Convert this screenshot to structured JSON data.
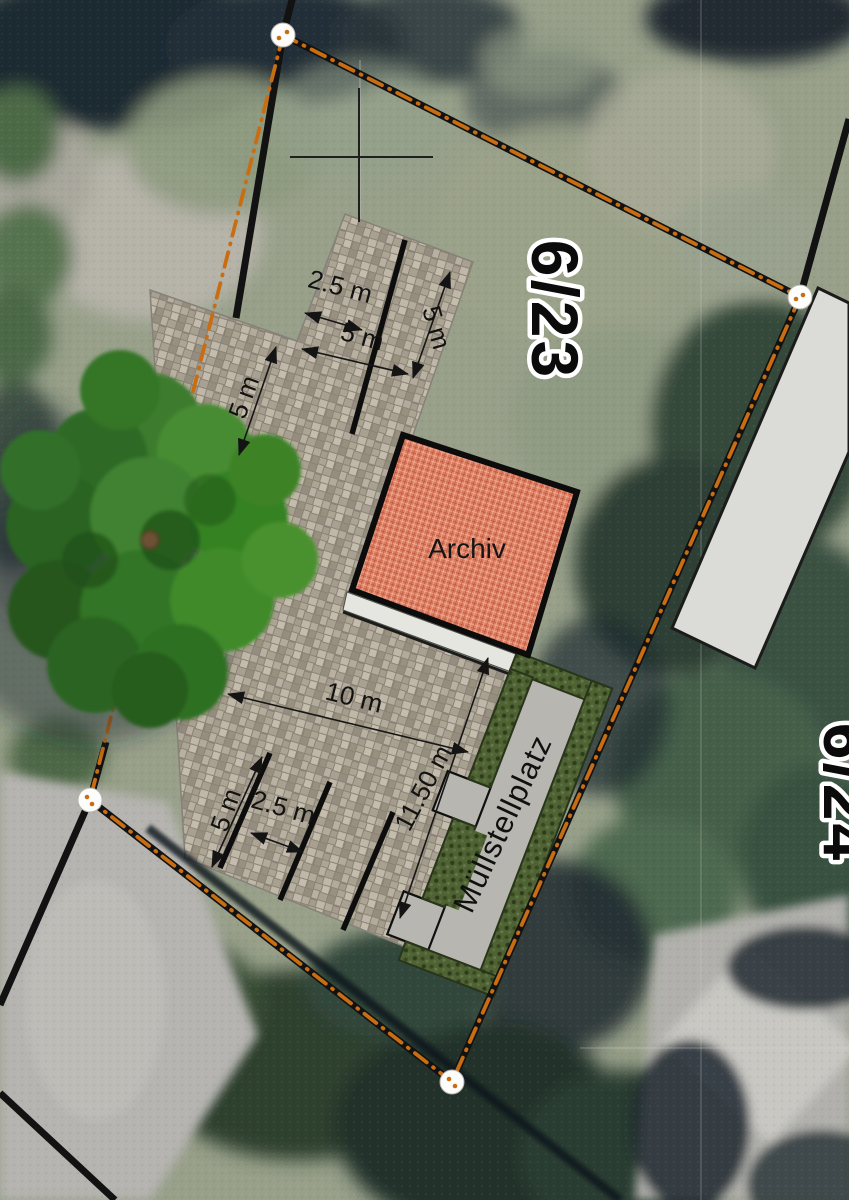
{
  "plan": {
    "parcel_label": "6/23",
    "adjacent_parcel_label": "6/24",
    "building_label": "Archiv",
    "waste_area_label": "Müllstellplatz",
    "dimensions": {
      "upper_offset": "2.5 m",
      "upper_right_depth": "5 m",
      "upper_center_width": "5 m",
      "upper_left_depth": "5 m",
      "lower_width": "10 m",
      "waste_strip_length": "11.50 m",
      "lower_offset": "2.5 m",
      "lower_left_depth": "5 m"
    },
    "colors": {
      "pavement_base": "#8a8275",
      "archiv_fill": "#dc7d61",
      "hedge_fill": "#4f6234",
      "path_fill": "#b7b6b0",
      "boundary_orange": "#c96d12",
      "walkway_fill": "#e6e6e0",
      "building_roof": "#dbdbd7"
    }
  }
}
